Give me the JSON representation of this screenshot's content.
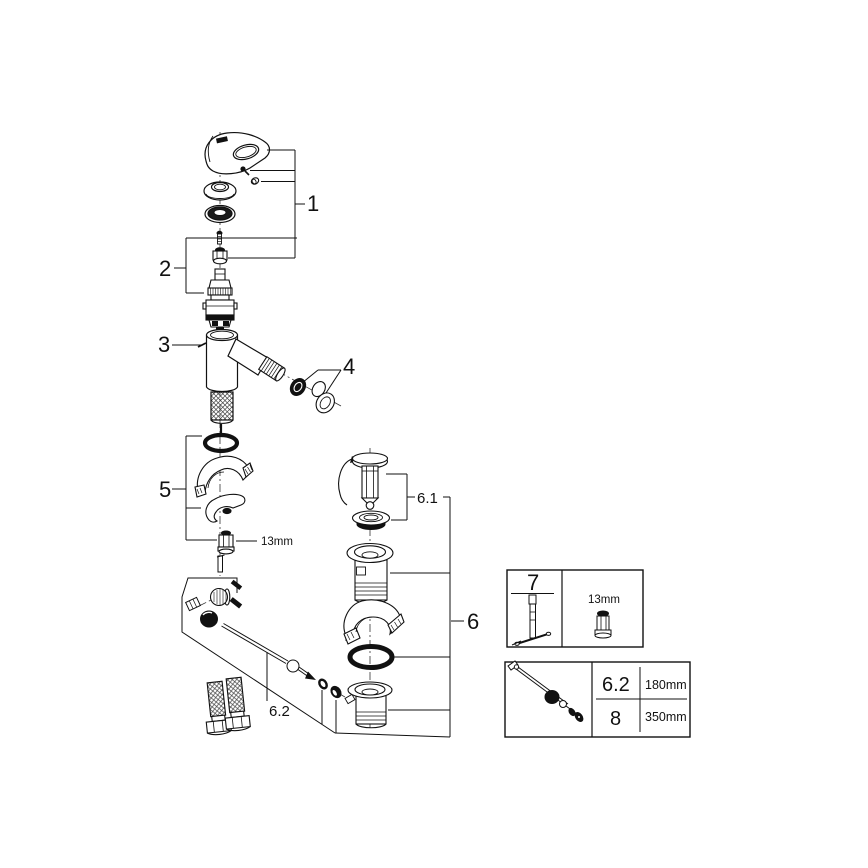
{
  "page": {
    "background": "#ffffff",
    "line_color": "#111111"
  },
  "callouts": {
    "c1": "1",
    "c2": "2",
    "c3": "3",
    "c4": "4",
    "c5": "5",
    "c6": "6",
    "c6_1": "6.1",
    "c6_2": "6.2"
  },
  "annotations": {
    "nut_size": "13mm"
  },
  "tool_box": {
    "part_number": "7",
    "wrench_size": "13mm"
  },
  "length_table": {
    "rows": [
      {
        "part": "6.2",
        "length": "180mm"
      },
      {
        "part": "8",
        "length": "350mm"
      }
    ]
  }
}
